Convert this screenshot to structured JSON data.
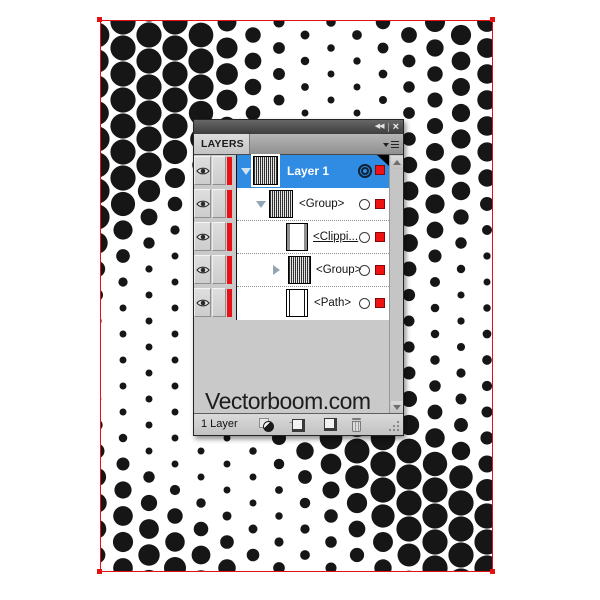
{
  "colors": {
    "selection_blue": "#2f8ce2",
    "layer_stripe_red": "#e81216",
    "indicator_red": "#ee1212",
    "artboard_border_red": "#e41114",
    "dot_black": "#161616"
  },
  "halftone": {
    "width": 391,
    "height": 550,
    "spacing": 26,
    "stagger": 13,
    "rmin": 3,
    "rmax": 12.6,
    "k1": 0.019,
    "k2": 1.8,
    "k3": 0.012,
    "k4": 0.8,
    "k5": 0.6,
    "k6": 0.008,
    "k7": 1.0,
    "color": "#161616"
  },
  "panel": {
    "titlebar": {
      "collapse_icon": "◀◀",
      "close_icon": "×"
    },
    "tab_label": "LAYERS",
    "rows": [
      {
        "label": "Layer 1",
        "selected": true,
        "disclosure": "expanded",
        "thumb": "pattern",
        "target": "selected"
      },
      {
        "label": "<Group>",
        "selected": false,
        "disclosure": "expanded",
        "thumb": "pattern",
        "target": "normal"
      },
      {
        "label": "<Clippi...",
        "selected": false,
        "disclosure": "none",
        "thumb": "clipping-path",
        "target": "normal"
      },
      {
        "label": "<Group>",
        "selected": false,
        "disclosure": "collapsed",
        "thumb": "pattern",
        "target": "normal"
      },
      {
        "label": "<Path>",
        "selected": false,
        "disclosure": "none",
        "thumb": "path",
        "target": "normal"
      }
    ],
    "watermark": "Vectorboom.com",
    "statusbar": {
      "status": "1 Layer",
      "buttons": [
        {
          "name": "make-release-clipping-mask"
        },
        {
          "name": "create-new-sublayer"
        },
        {
          "name": "create-new-layer"
        },
        {
          "name": "delete-selection"
        }
      ]
    }
  }
}
